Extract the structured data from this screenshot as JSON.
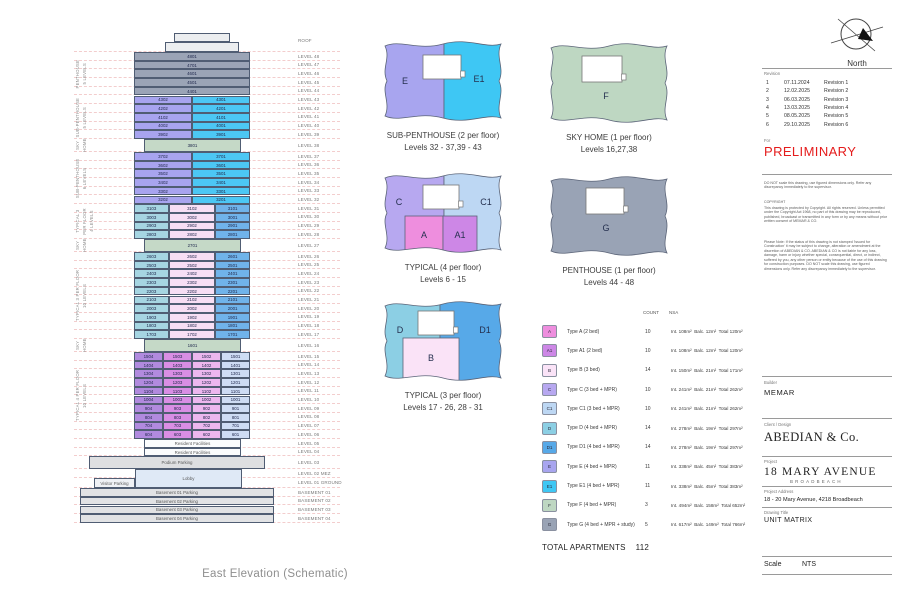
{
  "colors": {
    "ph": "#9ba4b6",
    "e": "#a8a4ef",
    "e1": "#4cc7f4",
    "sky": "#c5d9c7",
    "d": "#a6d5e2",
    "b": "#f7def4",
    "d1": "#70b3ea",
    "v4": "#b18ade",
    "m4": "#d98ee4",
    "p4": "#ecb7ee",
    "lb4": "#cedcf4",
    "fac": "#fbfcfd",
    "pod": "#dedfe1",
    "lob": "#dfe9f6",
    "vis": "#eff1f5",
    "bas": "#e2e3e5",
    "roof": "#eceef0",
    "types": {
      "A": "#ee8ede",
      "A1": "#cd87e6",
      "B": "#fae3f7",
      "C": "#b7a8f0",
      "C1": "#bdd7f3",
      "D": "#8ccfe4",
      "D1": "#57a9e8",
      "E": "#a8a5ef",
      "E1": "#3ec7f4",
      "F": "#bed7c2",
      "G": "#99a3b5"
    }
  },
  "elevation": {
    "caption": "East Elevation (Schematic)",
    "groups": [
      {
        "lines": [
          "PENTHOUSE",
          "5 LEVELS"
        ],
        "from": 1,
        "to": 5
      },
      {
        "lines": [
          "SUB-PENTHOUSE",
          "5 LEVELS"
        ],
        "from": 6,
        "to": 10
      },
      {
        "lines": [
          "SKY",
          "HOME"
        ],
        "from": 11,
        "to": 11
      },
      {
        "lines": [
          "SUB-PENTHOUSE",
          "6 LEVELS"
        ],
        "from": 12,
        "to": 17
      },
      {
        "lines": [
          "TYPICAL 3",
          "PER FLOOR",
          "4 LEVELS"
        ],
        "from": 18,
        "to": 21
      },
      {
        "lines": [
          "SKY",
          "HOME"
        ],
        "from": 22,
        "to": 22
      },
      {
        "lines": [
          "TYPICAL 3 PER FLOOR",
          "10 LEVELS"
        ],
        "from": 23,
        "to": 32
      },
      {
        "lines": [
          "SKY",
          "HOME"
        ],
        "from": 33,
        "to": 33
      },
      {
        "lines": [
          "TYPICAL 4 PER FLOOR",
          "10 LEVELS"
        ],
        "from": 34,
        "to": 43
      }
    ],
    "rows": [
      {
        "level": "ROOF",
        "kind": "roof"
      },
      {
        "level": "LEVEL 48",
        "cells": [
          {
            "t": "4801",
            "c": "ph"
          }
        ]
      },
      {
        "level": "LEVEL 47",
        "cells": [
          {
            "t": "4701",
            "c": "ph"
          }
        ]
      },
      {
        "level": "LEVEL 46",
        "cells": [
          {
            "t": "4601",
            "c": "ph"
          }
        ]
      },
      {
        "level": "LEVEL 45",
        "cells": [
          {
            "t": "4501",
            "c": "ph"
          }
        ]
      },
      {
        "level": "LEVEL 44",
        "cells": [
          {
            "t": "4401",
            "c": "ph"
          }
        ]
      },
      {
        "level": "LEVEL 43",
        "cells": [
          {
            "t": "4302",
            "c": "e"
          },
          {
            "t": "4301",
            "c": "e1"
          }
        ]
      },
      {
        "level": "LEVEL 42",
        "cells": [
          {
            "t": "4202",
            "c": "e"
          },
          {
            "t": "4201",
            "c": "e1"
          }
        ]
      },
      {
        "level": "LEVEL 41",
        "cells": [
          {
            "t": "4102",
            "c": "e"
          },
          {
            "t": "4101",
            "c": "e1"
          }
        ]
      },
      {
        "level": "LEVEL 40",
        "cells": [
          {
            "t": "4002",
            "c": "e"
          },
          {
            "t": "4001",
            "c": "e1"
          }
        ]
      },
      {
        "level": "LEVEL 39",
        "cells": [
          {
            "t": "3902",
            "c": "e"
          },
          {
            "t": "3901",
            "c": "e1"
          }
        ]
      },
      {
        "level": "LEVEL 38",
        "kind": "sky",
        "t": "3801"
      },
      {
        "level": "LEVEL 37",
        "cells": [
          {
            "t": "3702",
            "c": "e"
          },
          {
            "t": "3701",
            "c": "e1"
          }
        ]
      },
      {
        "level": "LEVEL 36",
        "cells": [
          {
            "t": "3602",
            "c": "e"
          },
          {
            "t": "3601",
            "c": "e1"
          }
        ]
      },
      {
        "level": "LEVEL 35",
        "cells": [
          {
            "t": "3502",
            "c": "e"
          },
          {
            "t": "3501",
            "c": "e1"
          }
        ]
      },
      {
        "level": "LEVEL 34",
        "cells": [
          {
            "t": "3402",
            "c": "e"
          },
          {
            "t": "3401",
            "c": "e1"
          }
        ]
      },
      {
        "level": "LEVEL 33",
        "cells": [
          {
            "t": "3302",
            "c": "e"
          },
          {
            "t": "3301",
            "c": "e1"
          }
        ]
      },
      {
        "level": "LEVEL 32",
        "cells": [
          {
            "t": "3202",
            "c": "e"
          },
          {
            "t": "3201",
            "c": "e1"
          }
        ]
      },
      {
        "level": "LEVEL 31",
        "cells": [
          {
            "t": "3103",
            "c": "d"
          },
          {
            "t": "3102",
            "c": "b"
          },
          {
            "t": "3101",
            "c": "d1"
          }
        ]
      },
      {
        "level": "LEVEL 30",
        "cells": [
          {
            "t": "3003",
            "c": "d"
          },
          {
            "t": "3002",
            "c": "b"
          },
          {
            "t": "3001",
            "c": "d1"
          }
        ]
      },
      {
        "level": "LEVEL 29",
        "cells": [
          {
            "t": "2903",
            "c": "d"
          },
          {
            "t": "2902",
            "c": "b"
          },
          {
            "t": "2901",
            "c": "d1"
          }
        ]
      },
      {
        "level": "LEVEL 28",
        "cells": [
          {
            "t": "2803",
            "c": "d"
          },
          {
            "t": "2802",
            "c": "b"
          },
          {
            "t": "2801",
            "c": "d1"
          }
        ]
      },
      {
        "level": "LEVEL 27",
        "kind": "sky",
        "t": "2701"
      },
      {
        "level": "LEVEL 26",
        "cells": [
          {
            "t": "2603",
            "c": "d"
          },
          {
            "t": "2602",
            "c": "b"
          },
          {
            "t": "2601",
            "c": "d1"
          }
        ]
      },
      {
        "level": "LEVEL 25",
        "cells": [
          {
            "t": "2503",
            "c": "d"
          },
          {
            "t": "2502",
            "c": "b"
          },
          {
            "t": "2501",
            "c": "d1"
          }
        ]
      },
      {
        "level": "LEVEL 24",
        "cells": [
          {
            "t": "2403",
            "c": "d"
          },
          {
            "t": "2402",
            "c": "b"
          },
          {
            "t": "2401",
            "c": "d1"
          }
        ]
      },
      {
        "level": "LEVEL 23",
        "cells": [
          {
            "t": "2303",
            "c": "d"
          },
          {
            "t": "2302",
            "c": "b"
          },
          {
            "t": "2301",
            "c": "d1"
          }
        ]
      },
      {
        "level": "LEVEL 22",
        "cells": [
          {
            "t": "2203",
            "c": "d"
          },
          {
            "t": "2202",
            "c": "b"
          },
          {
            "t": "2201",
            "c": "d1"
          }
        ]
      },
      {
        "level": "LEVEL 21",
        "cells": [
          {
            "t": "2103",
            "c": "d"
          },
          {
            "t": "2102",
            "c": "b"
          },
          {
            "t": "2101",
            "c": "d1"
          }
        ]
      },
      {
        "level": "LEVEL 20",
        "cells": [
          {
            "t": "2003",
            "c": "d"
          },
          {
            "t": "2002",
            "c": "b"
          },
          {
            "t": "2001",
            "c": "d1"
          }
        ]
      },
      {
        "level": "LEVEL 19",
        "cells": [
          {
            "t": "1903",
            "c": "d"
          },
          {
            "t": "1902",
            "c": "b"
          },
          {
            "t": "1901",
            "c": "d1"
          }
        ]
      },
      {
        "level": "LEVEL 18",
        "cells": [
          {
            "t": "1803",
            "c": "d"
          },
          {
            "t": "1802",
            "c": "b"
          },
          {
            "t": "1801",
            "c": "d1"
          }
        ]
      },
      {
        "level": "LEVEL 17",
        "cells": [
          {
            "t": "1703",
            "c": "d"
          },
          {
            "t": "1702",
            "c": "b"
          },
          {
            "t": "1701",
            "c": "d1"
          }
        ]
      },
      {
        "level": "LEVEL 16",
        "kind": "sky",
        "t": "1601"
      },
      {
        "level": "LEVEL 15",
        "cells": [
          {
            "t": "1504",
            "c": "v4"
          },
          {
            "t": "1503",
            "c": "m4"
          },
          {
            "t": "1502",
            "c": "p4"
          },
          {
            "t": "1501",
            "c": "lb4"
          }
        ]
      },
      {
        "level": "LEVEL 14",
        "cells": [
          {
            "t": "1404",
            "c": "v4"
          },
          {
            "t": "1403",
            "c": "m4"
          },
          {
            "t": "1402",
            "c": "p4"
          },
          {
            "t": "1401",
            "c": "lb4"
          }
        ]
      },
      {
        "level": "LEVEL 13",
        "cells": [
          {
            "t": "1304",
            "c": "v4"
          },
          {
            "t": "1303",
            "c": "m4"
          },
          {
            "t": "1302",
            "c": "p4"
          },
          {
            "t": "1301",
            "c": "lb4"
          }
        ]
      },
      {
        "level": "LEVEL 12",
        "cells": [
          {
            "t": "1204",
            "c": "v4"
          },
          {
            "t": "1203",
            "c": "m4"
          },
          {
            "t": "1202",
            "c": "p4"
          },
          {
            "t": "1201",
            "c": "lb4"
          }
        ]
      },
      {
        "level": "LEVEL 11",
        "cells": [
          {
            "t": "1104",
            "c": "v4"
          },
          {
            "t": "1103",
            "c": "m4"
          },
          {
            "t": "1102",
            "c": "p4"
          },
          {
            "t": "1101",
            "c": "lb4"
          }
        ]
      },
      {
        "level": "LEVEL 10",
        "cells": [
          {
            "t": "1004",
            "c": "v4"
          },
          {
            "t": "1003",
            "c": "m4"
          },
          {
            "t": "1002",
            "c": "p4"
          },
          {
            "t": "1001",
            "c": "lb4"
          }
        ]
      },
      {
        "level": "LEVEL 09",
        "cells": [
          {
            "t": "904",
            "c": "v4"
          },
          {
            "t": "903",
            "c": "m4"
          },
          {
            "t": "902",
            "c": "p4"
          },
          {
            "t": "901",
            "c": "lb4"
          }
        ]
      },
      {
        "level": "LEVEL 08",
        "cells": [
          {
            "t": "804",
            "c": "v4"
          },
          {
            "t": "803",
            "c": "m4"
          },
          {
            "t": "802",
            "c": "p4"
          },
          {
            "t": "801",
            "c": "lb4"
          }
        ]
      },
      {
        "level": "LEVEL 07",
        "cells": [
          {
            "t": "704",
            "c": "v4"
          },
          {
            "t": "703",
            "c": "m4"
          },
          {
            "t": "702",
            "c": "p4"
          },
          {
            "t": "701",
            "c": "lb4"
          }
        ]
      },
      {
        "level": "LEVEL 06",
        "cells": [
          {
            "t": "604",
            "c": "v4"
          },
          {
            "t": "603",
            "c": "m4"
          },
          {
            "t": "602",
            "c": "p4"
          },
          {
            "t": "601",
            "c": "lb4"
          }
        ]
      },
      {
        "level": "LEVEL 05",
        "kind": "fac",
        "text": "Resident Facilities"
      },
      {
        "level": "LEVEL 04",
        "kind": "fac",
        "text": "Resident Facilities"
      },
      {
        "level": "LEVEL 03",
        "kind": "podium",
        "text": "Podium Parking"
      },
      {
        "level": "LEVEL 02 MEZ",
        "kind": "mez",
        "text": "Lobby"
      },
      {
        "level": "LEVEL 01 GROUND",
        "kind": "ground",
        "text": "Visitor Parking"
      },
      {
        "level": "BASEMENT 01",
        "kind": "basement",
        "text": "Basement 01 Parking"
      },
      {
        "level": "BASEMENT 02",
        "kind": "basement",
        "text": "Basement 02 Parking"
      },
      {
        "level": "BASEMENT 03",
        "kind": "basement",
        "text": "Basement 03 Parking"
      },
      {
        "level": "BASEMENT 04",
        "kind": "basement",
        "text": "Basement 04 Parking"
      }
    ]
  },
  "plans": [
    {
      "title": "SUB-PENTHOUSE (2 per floor)",
      "levels": "Levels 32 - 37,39 - 43",
      "regions": {
        "left": "E",
        "right": "E1"
      }
    },
    {
      "title": "SKY HOME (1 per floor)",
      "levels": "Levels 16,27,38",
      "regions": {
        "full": "F"
      }
    },
    {
      "title": "TYPICAL (4 per floor)",
      "levels": "Levels 6 - 15",
      "regions": {
        "left": "C",
        "right": "C1",
        "bottom_left": "A",
        "bottom_right": "A1"
      }
    },
    {
      "title": "PENTHOUSE (1 per floor)",
      "levels": "Levels 44 - 48",
      "regions": {
        "full": "G"
      }
    },
    {
      "title": "TYPICAL (3 per floor)",
      "levels": "Levels 17 - 26, 28 - 31",
      "regions": {
        "left": "D",
        "right": "D1",
        "bottom": "B"
      }
    }
  ],
  "legend": {
    "headers": {
      "count": "COUNT",
      "nsa": "NSA"
    },
    "rows": [
      {
        "letter": "A",
        "label": "Type A  (2 bed)",
        "count": "10",
        "nsa": "Int. 108m²  Balc. 12m²  Total 120m²"
      },
      {
        "letter": "A1",
        "label": "Type A1  (2 bed)",
        "count": "10",
        "nsa": "Int. 108m²  Balc. 12m²  Total 120m²"
      },
      {
        "letter": "B",
        "label": "Type B  (3 bed)",
        "count": "14",
        "nsa": "Int. 150m²  Balc. 21m²  Total 171m²"
      },
      {
        "letter": "C",
        "label": "Type C  (3 bed + MPR)",
        "count": "10",
        "nsa": "Int. 241m²  Balc. 21m²  Total 262m²"
      },
      {
        "letter": "C1",
        "label": "Type C1  (3 bed + MPR)",
        "count": "10",
        "nsa": "Int. 241m²  Balc. 21m²  Total 262m²"
      },
      {
        "letter": "D",
        "label": "Type D  (4 bed + MPR)",
        "count": "14",
        "nsa": "Int. 278m²  Balc. 19m²  Total 297m²"
      },
      {
        "letter": "D1",
        "label": "Type D1  (4 bed + MPR)",
        "count": "14",
        "nsa": "Int. 278m²  Balc. 19m²  Total 297m²"
      },
      {
        "letter": "E",
        "label": "Type E  (4 bed + MPR)",
        "count": "11",
        "nsa": "Int. 338m²  Balc. 45m²  Total 383m²"
      },
      {
        "letter": "E1",
        "label": "Type E1  (4 bed + MPR)",
        "count": "11",
        "nsa": "Int. 338m²  Balc. 45m²  Total 383m²"
      },
      {
        "letter": "F",
        "label": "Type F  (4 bed + MPR)",
        "count": "3",
        "nsa": "Int. 494m²  Balc. 158m²  Total 652m²"
      },
      {
        "letter": "G",
        "label": "Type G  (4 bed + MPR + study)",
        "count": "5",
        "nsa": "Int. 617m²  Balc. 149m²  Total 766m²"
      }
    ],
    "total_label": "TOTAL APARTMENTS",
    "total_value": "112"
  },
  "titleblock": {
    "north_label": "North",
    "revision_header": "Revision",
    "revisions": [
      {
        "num": "1",
        "date": "07.11.2024",
        "label": "Revision 1"
      },
      {
        "num": "2",
        "date": "12.02.2025",
        "label": "Revision 2"
      },
      {
        "num": "3",
        "date": "06.03.2025",
        "label": "Revision 3"
      },
      {
        "num": "4",
        "date": "13.03.2025",
        "label": "Revision 4"
      },
      {
        "num": "5",
        "date": "08.05.2025",
        "label": "Revision 5"
      },
      {
        "num": "6",
        "date": "29.10.2025",
        "label": "Revision 6"
      }
    ],
    "for_label": "For",
    "status": "PRELIMINARY",
    "notes": [
      "DO NOT scale this drawing, use figured dimensions only.  Refer any discrepancy immediately to the supervisor.",
      "COPYRIGHT",
      "This drawing is protected by Copyright. All rights reserved. Unless permitted under the Copyright Act 1968, no part of this drawing may be reproduced, published, broadcast or transmitted in any form or by any means without prior written consent of MEMAR & CO.",
      "Please Note: If the status of this drawing is not stamped 'Issued for Construction' it may be subject to change, alteration or amendment at the discretion of ABEDIAN & CO. ABEDIAN & CO is not liable for any loss, damage, harm or injury whether special, consequential, direct, or indirect, suffered by you, any other person or entity because of the use of this drawing for construction purposes. DO NOT scale this drawing, use figured dimensions only. Refer any discrepancy immediately to the supervisor."
    ],
    "builder_label": "Builder",
    "builder": "MEMAR",
    "client_label": "Client / Design",
    "client": "ABEDIAN & Co.",
    "project_label": "Project",
    "project": "18 MARY AVENUE",
    "project_sub": "BROADBEACH",
    "address_label": "Project Address",
    "address": "18 - 20 Mary Avenue, 4218 Broadbeach",
    "drawing_label": "Drawing Title",
    "drawing": "UNIT MATRIX",
    "scale_label": "Scale",
    "scale_value": "NTS"
  }
}
